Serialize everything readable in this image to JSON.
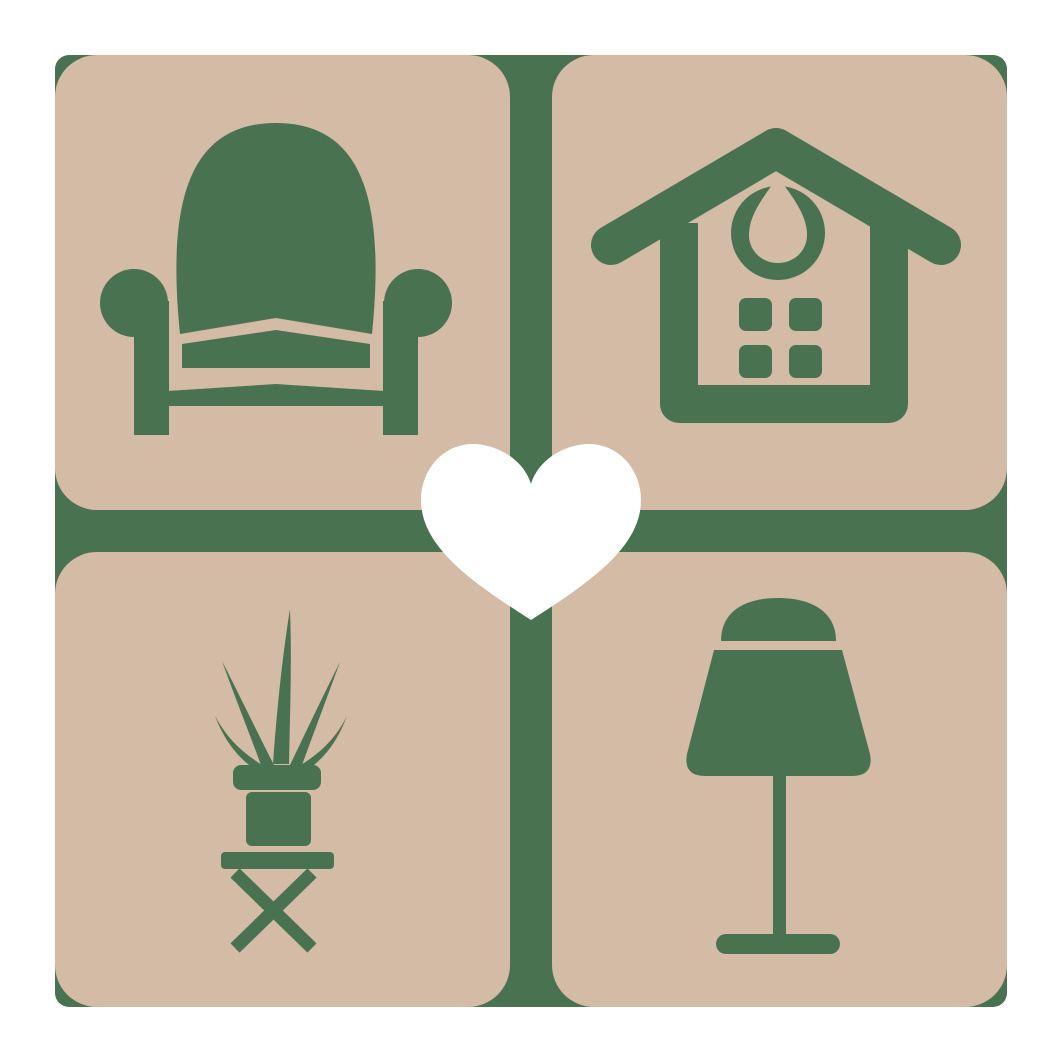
{
  "logo": {
    "colors": {
      "background": "#ffffff",
      "tile": "#d4bba5",
      "green": "#497350",
      "heart": "#ffffff"
    },
    "grid": {
      "rows": 2,
      "cols": 2,
      "tile_size": 455,
      "gap": 42,
      "margin": 55,
      "tile_corner_radius": 42
    },
    "tiles": [
      {
        "position": "top-left",
        "icon": "armchair-icon"
      },
      {
        "position": "top-right",
        "icon": "house-icon"
      },
      {
        "position": "bottom-left",
        "icon": "potted-plant-icon"
      },
      {
        "position": "bottom-right",
        "icon": "table-lamp-icon"
      }
    ],
    "center_icon": "heart-icon"
  }
}
